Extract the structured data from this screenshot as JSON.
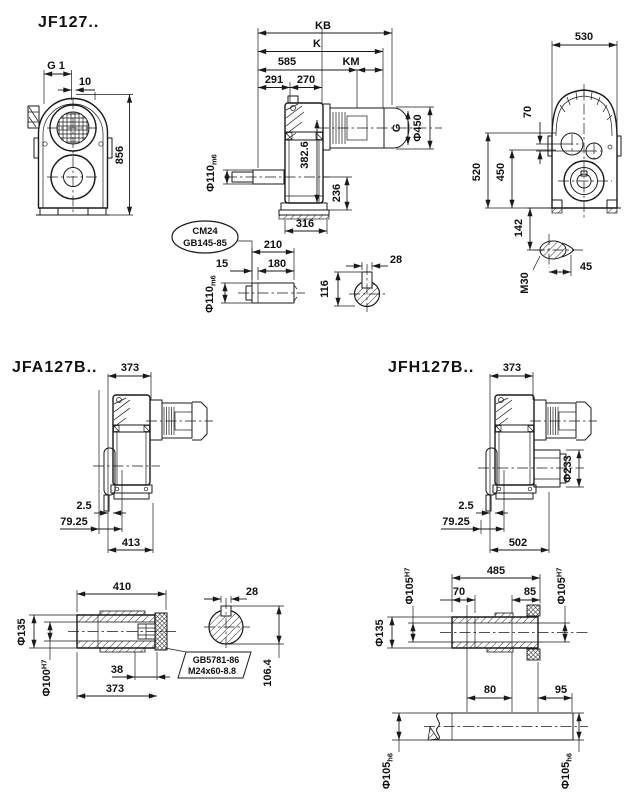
{
  "drawing": {
    "jf": {
      "title": "JF127..",
      "front": {
        "g1": "G 1",
        "w10": "10",
        "h856": "856"
      },
      "side": {
        "kb": "KB",
        "k": "K",
        "l585": "585",
        "km": "KM",
        "l291": "291",
        "l270": "270",
        "g": "G",
        "d450": "Φ450",
        "h382": "382.6",
        "h236": "236",
        "w316": "316",
        "shaft_d": "Φ110",
        "shaft_tol": "m6"
      },
      "rear": {
        "w530": "530",
        "h70": "70",
        "h520": "520",
        "h450": "450",
        "h142": "142",
        "m30": "M30",
        "w45": "45"
      },
      "shaft_detail": {
        "callout1": "CM24",
        "callout2": "GB145-85",
        "l210": "210",
        "l180": "180",
        "l15": "15",
        "d": "Φ110",
        "tol": "m6"
      },
      "key_detail": {
        "w28": "28",
        "h116": "116"
      }
    },
    "jfa": {
      "title": "JFA127B..",
      "w373": "373",
      "g2_5": "2.5",
      "g79": "79.25",
      "w413": "413"
    },
    "jfh": {
      "title": "JFH127B..",
      "w373": "373",
      "d233": "Φ233",
      "g2_5": "2.5",
      "g79": "79.25",
      "w502": "502"
    },
    "jfa_shaft": {
      "w410": "410",
      "d135": "Φ135",
      "d100": "Φ100",
      "d100_tol": "H7",
      "w38": "38",
      "w373": "373",
      "w28": "28",
      "h106": "106.4",
      "note1": "GB5781-86",
      "note2": "M24x60-8.8"
    },
    "jfh_shaft": {
      "w485": "485",
      "d105l": "Φ105",
      "d105l_tol": "H7",
      "d105r": "Φ105",
      "d105r_tol": "H7",
      "w70": "70",
      "w85": "85",
      "d135": "Φ135",
      "w80": "80",
      "w95": "95",
      "d105bl": "Φ105",
      "d105bl_tol": "h6",
      "d105br": "Φ105",
      "d105br_tol": "h6"
    }
  }
}
